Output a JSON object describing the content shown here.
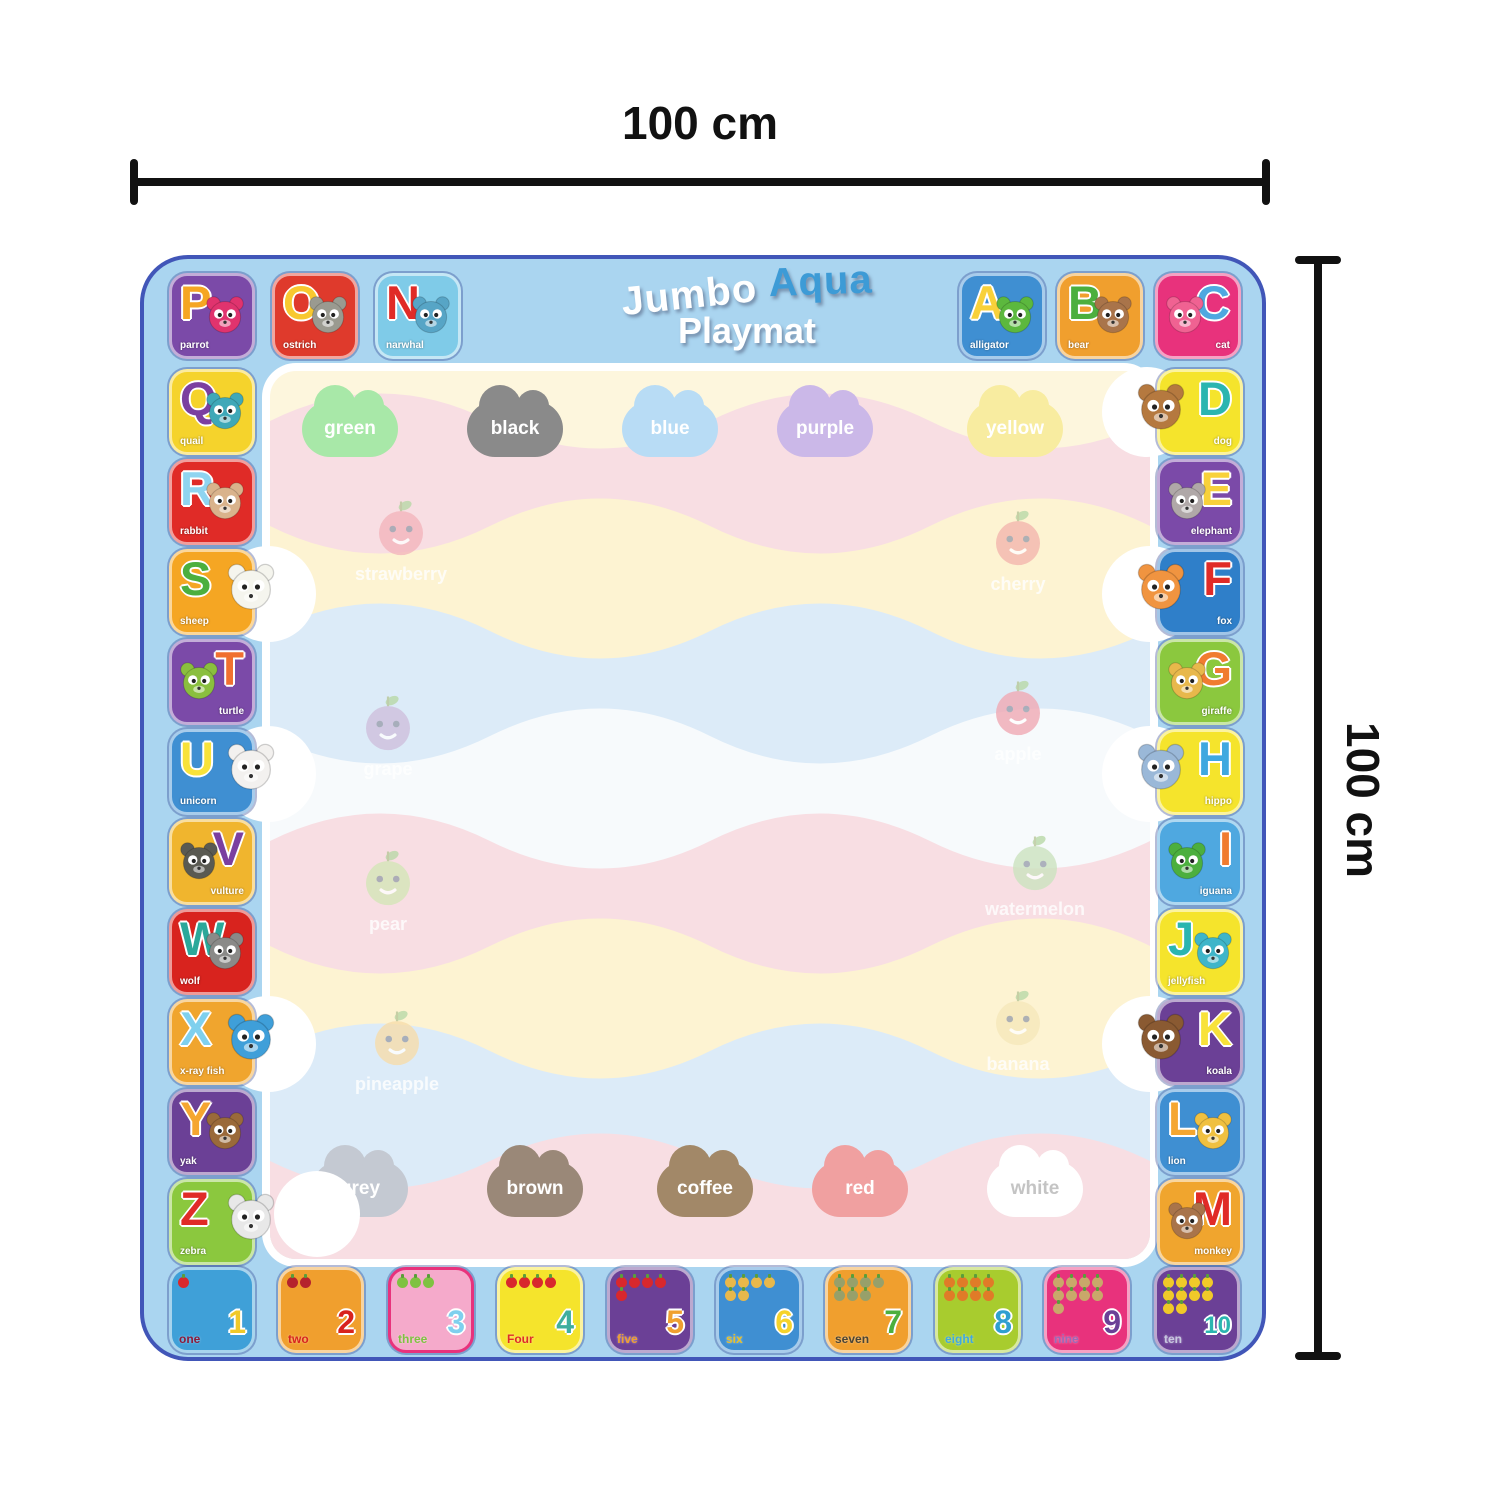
{
  "dimension_labels": {
    "top": "100 cm",
    "right": "100 cm"
  },
  "title": {
    "word1": "Jumbo",
    "word2": "Aqua",
    "word2_color": "#3d9bd6",
    "word3": "Playmat"
  },
  "mat": {
    "bg": "#aad5f0",
    "border": "#4156b8"
  },
  "alphabet_tiles": {
    "top_left": [
      {
        "letter": "P",
        "word": "parrot",
        "bg": "#7b4aa8",
        "fg": "#f5a623",
        "animal": "parrot",
        "animal_color": "#e0336e",
        "side": "left",
        "poke": false
      },
      {
        "letter": "O",
        "word": "ostrich",
        "bg": "#df3a2c",
        "fg": "#f8c830",
        "animal": "ostrich",
        "animal_color": "#9a9a90",
        "side": "left",
        "poke": false
      },
      {
        "letter": "N",
        "word": "narwhal",
        "bg": "#7fcbe8",
        "fg": "#e02b27",
        "animal": "narwhal",
        "animal_color": "#57a5c6",
        "side": "left",
        "poke": false
      }
    ],
    "top_right": [
      {
        "letter": "A",
        "word": "alligator",
        "bg": "#3f8fd2",
        "fg": "#f8d13a",
        "animal": "alligator",
        "animal_color": "#5cb83e",
        "side": "left",
        "poke": false
      },
      {
        "letter": "B",
        "word": "bear",
        "bg": "#f09f2e",
        "fg": "#4caf3e",
        "animal": "bear",
        "animal_color": "#a9744a",
        "side": "left",
        "poke": false
      },
      {
        "letter": "C",
        "word": "cat",
        "bg": "#e8327c",
        "fg": "#4fa8e0",
        "animal": "cat",
        "animal_color": "#f06292",
        "side": "right",
        "poke": false
      }
    ],
    "left_column": [
      {
        "letter": "Q",
        "word": "quail",
        "bg": "#f5d32c",
        "fg": "#7b3fa0",
        "animal": "quail",
        "animal_color": "#3fa8b8",
        "side": "left",
        "poke": false
      },
      {
        "letter": "R",
        "word": "rabbit",
        "bg": "#e02b27",
        "fg": "#8fd4f0",
        "animal": "rabbit",
        "animal_color": "#d9b38c",
        "side": "left",
        "poke": false
      },
      {
        "letter": "S",
        "word": "sheep",
        "bg": "#f5a623",
        "fg": "#4caf3e",
        "animal": "sheep",
        "animal_color": "#f5f5ee",
        "side": "left",
        "poke": true
      },
      {
        "letter": "T",
        "word": "turtle",
        "bg": "#7b4aa8",
        "fg": "#f07030",
        "animal": "turtle",
        "animal_color": "#8abf3e",
        "side": "right",
        "poke": false
      },
      {
        "letter": "U",
        "word": "unicorn",
        "bg": "#3f8fd2",
        "fg": "#f8e23a",
        "animal": "unicorn",
        "animal_color": "#f3f1ef",
        "side": "left",
        "poke": true
      },
      {
        "letter": "V",
        "word": "vulture",
        "bg": "#f0b52e",
        "fg": "#7b3fa0",
        "animal": "vulture",
        "animal_color": "#5a5a52",
        "side": "right",
        "poke": false
      },
      {
        "letter": "W",
        "word": "wolf",
        "bg": "#d8231e",
        "fg": "#2ba89a",
        "animal": "wolf",
        "animal_color": "#8a8a88",
        "side": "left",
        "poke": false
      },
      {
        "letter": "X",
        "word": "x-ray fish",
        "bg": "#f0a52e",
        "fg": "#7fd0ee",
        "animal": "x-ray-fish",
        "animal_color": "#3f9fd9",
        "side": "left",
        "poke": true
      },
      {
        "letter": "Y",
        "word": "yak",
        "bg": "#6b4096",
        "fg": "#f5a630",
        "animal": "yak",
        "animal_color": "#9a6a3a",
        "side": "left",
        "poke": false
      },
      {
        "letter": "Z",
        "word": "zebra",
        "bg": "#8bc83e",
        "fg": "#e02b27",
        "animal": "zebra",
        "animal_color": "#e8e8e8",
        "side": "left",
        "poke": true
      }
    ],
    "right_column": [
      {
        "letter": "D",
        "word": "dog",
        "bg": "#f5e42c",
        "fg": "#2bb5b0",
        "animal": "dog",
        "animal_color": "#b5793f",
        "side": "right",
        "poke": true
      },
      {
        "letter": "E",
        "word": "elephant",
        "bg": "#7b4aa8",
        "fg": "#f8d13a",
        "animal": "elephant",
        "animal_color": "#b0a8a8",
        "side": "right",
        "poke": false
      },
      {
        "letter": "F",
        "word": "fox",
        "bg": "#2f7fc9",
        "fg": "#e02b27",
        "animal": "fox",
        "animal_color": "#f09440",
        "side": "right",
        "poke": true
      },
      {
        "letter": "G",
        "word": "giraffe",
        "bg": "#8bc83e",
        "fg": "#f07c30",
        "animal": "giraffe",
        "animal_color": "#e8b84b",
        "side": "right",
        "poke": false
      },
      {
        "letter": "H",
        "word": "hippo",
        "bg": "#f5e42c",
        "fg": "#3fa8e0",
        "animal": "hippo",
        "animal_color": "#9ab8d8",
        "side": "right",
        "poke": true
      },
      {
        "letter": "I",
        "word": "iguana",
        "bg": "#4fa8e0",
        "fg": "#f07c30",
        "animal": "iguana",
        "animal_color": "#4caf3e",
        "side": "right",
        "poke": false
      },
      {
        "letter": "J",
        "word": "jellyfish",
        "bg": "#f5e42c",
        "fg": "#2bb5b0",
        "animal": "jellyfish",
        "animal_color": "#3fb5c9",
        "side": "left",
        "poke": false
      },
      {
        "letter": "K",
        "word": "koala",
        "bg": "#6b4096",
        "fg": "#f8e23a",
        "animal": "koala",
        "animal_color": "#8a5a32",
        "side": "right",
        "poke": true
      },
      {
        "letter": "L",
        "word": "lion",
        "bg": "#3f8fd2",
        "fg": "#f5a630",
        "animal": "lion",
        "animal_color": "#f0c040",
        "side": "left",
        "poke": false
      },
      {
        "letter": "M",
        "word": "monkey",
        "bg": "#f0a52e",
        "fg": "#e02b27",
        "animal": "monkey",
        "animal_color": "#a9744a",
        "side": "right",
        "poke": false
      }
    ]
  },
  "number_tiles": [
    {
      "label": "one",
      "count": 1,
      "numeral": "1",
      "bg": "#3fa0d8",
      "label_color": "#8b1a3a",
      "numeral_color": "#f0c929",
      "fruit": "apple",
      "fruit_color": "#d8282d",
      "border": "rgba(255,255,255,.55)"
    },
    {
      "label": "two",
      "count": 2,
      "numeral": "2",
      "bg": "#f09f2e",
      "label_color": "#d8231e",
      "numeral_color": "#d8231e",
      "fruit": "cherry",
      "fruit_color": "#b5232d",
      "border": "rgba(255,255,255,.55)"
    },
    {
      "label": "three",
      "count": 3,
      "numeral": "3",
      "bg": "#f5aacb",
      "label_color": "#7fc241",
      "numeral_color": "#7fd0ee",
      "fruit": "green-apple",
      "fruit_color": "#7fc241",
      "border": "#e8327c"
    },
    {
      "label": "Four",
      "count": 4,
      "numeral": "4",
      "bg": "#f5e42c",
      "label_color": "#e02b27",
      "numeral_color": "#3fae9e",
      "fruit": "mushroom",
      "fruit_color": "#d8282d",
      "border": "rgba(255,255,255,.55)"
    },
    {
      "label": "five",
      "count": 5,
      "numeral": "5",
      "bg": "#6b4096",
      "label_color": "#f0a030",
      "numeral_color": "#f0a030",
      "fruit": "apple",
      "fruit_color": "#d8282d",
      "border": "rgba(255,255,255,.55)"
    },
    {
      "label": "six",
      "count": 6,
      "numeral": "6",
      "bg": "#3f8fd2",
      "label_color": "#e8c02a",
      "numeral_color": "#f5d32c",
      "fruit": "pineapple",
      "fruit_color": "#e8b84b",
      "border": "rgba(255,255,255,.55)"
    },
    {
      "label": "seven",
      "count": 7,
      "numeral": "7",
      "bg": "#f09f2e",
      "label_color": "#4a4435",
      "numeral_color": "#4caf3e",
      "fruit": "coconut",
      "fruit_color": "#97a06a",
      "border": "rgba(255,255,255,.55)"
    },
    {
      "label": "eight",
      "count": 8,
      "numeral": "8",
      "bg": "#a8cc2e",
      "label_color": "#3fa8e0",
      "numeral_color": "#2f9fd0",
      "fruit": "carrot",
      "fruit_color": "#e07b28",
      "border": "rgba(255,255,255,.55)"
    },
    {
      "label": "nine",
      "count": 9,
      "numeral": "9",
      "bg": "#e8327c",
      "label_color": "#9a6ab8",
      "numeral_color": "#6b4096",
      "fruit": "nut",
      "fruit_color": "#c9a86a",
      "border": "rgba(255,255,255,.55)"
    },
    {
      "label": "ten",
      "count": 10,
      "numeral": "10",
      "bg": "#6b4096",
      "label_color": "#c8c8e0",
      "numeral_color": "#2bb5b0",
      "fruit": "corn",
      "fruit_color": "#f0c929",
      "border": "rgba(255,255,255,.55)"
    }
  ],
  "play_area": {
    "color_words_top": [
      {
        "word": "green",
        "color": "#a8e8a8",
        "text_color": "#ffffff"
      },
      {
        "word": "black",
        "color": "#8a8a8a",
        "text_color": "#ffffff"
      },
      {
        "word": "blue",
        "color": "#b8dcf5",
        "text_color": "#ffffff"
      },
      {
        "word": "purple",
        "color": "#cbb8e8",
        "text_color": "#ffffff"
      },
      {
        "word": "yellow",
        "color": "#f8eca0",
        "text_color": "#ffffff"
      }
    ],
    "color_words_bottom": [
      {
        "word": "grey",
        "color": "#c4c9d2",
        "text_color": "#ffffff"
      },
      {
        "word": "brown",
        "color": "#9a8878",
        "text_color": "#ffffff"
      },
      {
        "word": "coffee",
        "color": "#a28868",
        "text_color": "#ffffff"
      },
      {
        "word": "red",
        "color": "#f0a0a0",
        "text_color": "#ffffff"
      },
      {
        "word": "white",
        "color": "#ffffff",
        "text_color": "#c4c4c4"
      }
    ],
    "fruits_left": [
      {
        "label": "strawberry",
        "color": "#f4b6bd"
      },
      {
        "label": "grape",
        "color": "#cfc0dd"
      },
      {
        "label": "pear",
        "color": "#d4e6b8"
      },
      {
        "label": "pineapple",
        "color": "#f7ddab"
      }
    ],
    "fruits_right": [
      {
        "label": "cherry",
        "color": "#f4b6ae"
      },
      {
        "label": "apple",
        "color": "#f0a9b4"
      },
      {
        "label": "watermelon",
        "color": "#cce3c0"
      },
      {
        "label": "banana",
        "color": "#f6e8bb"
      }
    ]
  }
}
